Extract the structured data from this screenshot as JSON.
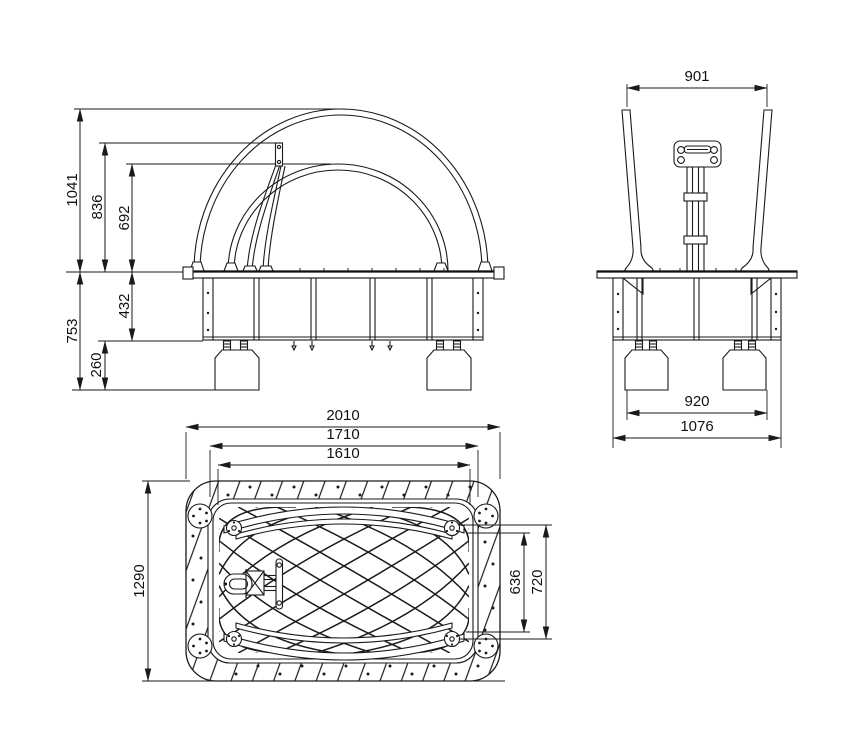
{
  "drawing": {
    "type": "technical-orthographic-drawing",
    "line_color": "#1a1a1a",
    "background": "#ffffff",
    "front_view": {
      "height_total": "1041",
      "height_handle": "836",
      "height_inner_arc": "692",
      "depth_below_total": "753",
      "depth_frame": "432",
      "footing_height": "260"
    },
    "side_view": {
      "top_width": "901",
      "footing_span": "920",
      "base_width": "1076"
    },
    "plan_view": {
      "length_total": "2010",
      "length_frame": "1710",
      "length_mat": "1610",
      "width_total": "1290",
      "net_width": "636",
      "tube_width": "720"
    }
  }
}
